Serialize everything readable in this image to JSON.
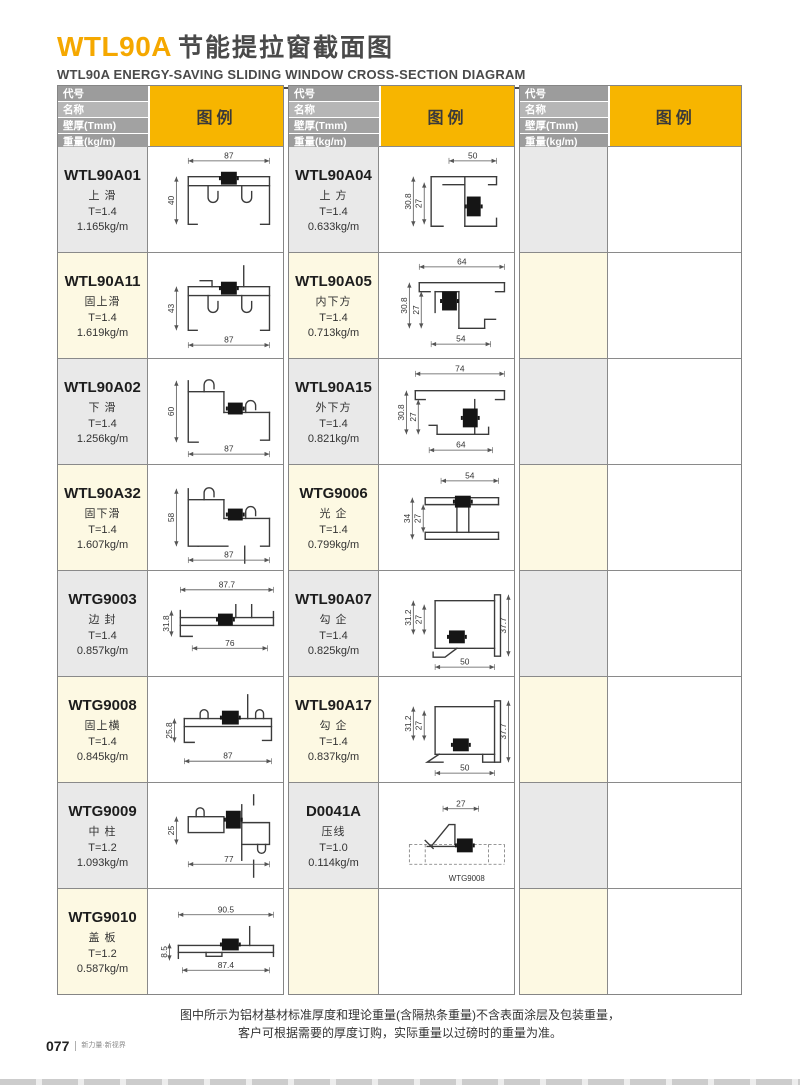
{
  "page": {
    "title_code": "WTL90A",
    "title_cn": "节能提拉窗截面图",
    "subtitle": "WTL90A ENERGY-SAVING SLIDING WINDOW CROSS-SECTION DIAGRAM",
    "note_line1": "图中所示为铝材基材标准厚度和理论重量(含隔热条重量)不含表面涂层及包装重量，",
    "note_line2": "客户可根据需要的厚度订购，实际重量以过磅时的重量为准。",
    "page_number": "077",
    "brand": "新力量·新视界"
  },
  "table_header": {
    "col_labels": [
      "代号",
      "名称",
      "壁厚(Tmm)",
      "重量(kg/m)"
    ],
    "legend_label": "图例"
  },
  "colors": {
    "accent_yellow": "#f7b500",
    "title_orange": "#f5a800",
    "header_gray_dark": "#9c9c9c",
    "header_gray_light": "#b6b6b6",
    "info_gray": "#e9e9e9",
    "info_cream": "#fdf9e3"
  },
  "columns": [
    {
      "rows": [
        {
          "code": "WTL90A01",
          "name": "上 滑",
          "thickness": "T=1.4",
          "weight": "1.165kg/m",
          "dims": {
            "top": "87",
            "left": "40"
          }
        },
        {
          "code": "WTL90A11",
          "name": "固上滑",
          "thickness": "T=1.4",
          "weight": "1.619kg/m",
          "dims": {
            "left": "43",
            "bottom": "87"
          }
        },
        {
          "code": "WTL90A02",
          "name": "下 滑",
          "thickness": "T=1.4",
          "weight": "1.256kg/m",
          "dims": {
            "left": "60",
            "bottom": "87"
          }
        },
        {
          "code": "WTL90A32",
          "name": "固下滑",
          "thickness": "T=1.4",
          "weight": "1.607kg/m",
          "dims": {
            "left": "58",
            "bottom": "87"
          }
        },
        {
          "code": "WTG9003",
          "name": "边 封",
          "thickness": "T=1.4",
          "weight": "0.857kg/m",
          "dims": {
            "top": "87.7",
            "left": "31.8",
            "bottom": "76"
          }
        },
        {
          "code": "WTG9008",
          "name": "固上横",
          "thickness": "T=1.4",
          "weight": "0.845kg/m",
          "dims": {
            "left": "25.8",
            "bottom": "87"
          }
        },
        {
          "code": "WTG9009",
          "name": "中 柱",
          "thickness": "T=1.2",
          "weight": "1.093kg/m",
          "dims": {
            "left": "25",
            "bottom": "77"
          }
        },
        {
          "code": "WTG9010",
          "name": "盖 板",
          "thickness": "T=1.2",
          "weight": "0.587kg/m",
          "dims": {
            "top": "90.5",
            "left": "8.5",
            "bottom": "87.4"
          }
        }
      ]
    },
    {
      "rows": [
        {
          "code": "WTL90A04",
          "name": "上 方",
          "thickness": "T=1.4",
          "weight": "0.633kg/m",
          "dims": {
            "top": "50",
            "left": "30.8",
            "inner": "27"
          }
        },
        {
          "code": "WTL90A05",
          "name": "内下方",
          "thickness": "T=1.4",
          "weight": "0.713kg/m",
          "dims": {
            "top": "64",
            "left": "30.8",
            "inner": "27",
            "bottom": "54"
          }
        },
        {
          "code": "WTL90A15",
          "name": "外下方",
          "thickness": "T=1.4",
          "weight": "0.821kg/m",
          "dims": {
            "top": "74",
            "left": "30.8",
            "inner": "27",
            "bottom": "64"
          }
        },
        {
          "code": "WTG9006",
          "name": "光 企",
          "thickness": "T=1.4",
          "weight": "0.799kg/m",
          "dims": {
            "top": "54",
            "left": "34",
            "inner": "27"
          }
        },
        {
          "code": "WTL90A07",
          "name": "勾 企",
          "thickness": "T=1.4",
          "weight": "0.825kg/m",
          "dims": {
            "left": "31.2",
            "inner": "27",
            "right": "37.7",
            "bottom": "50"
          }
        },
        {
          "code": "WTL90A17",
          "name": "勾 企",
          "thickness": "T=1.4",
          "weight": "0.837kg/m",
          "dims": {
            "left": "31.2",
            "inner": "27",
            "right": "37.7",
            "bottom": "50"
          }
        },
        {
          "code": "D0041A",
          "name": "压线",
          "thickness": "T=1.0",
          "weight": "0.114kg/m",
          "dims": {
            "top": "27"
          },
          "ref": "WTG9008"
        },
        {
          "empty": true
        }
      ]
    },
    {
      "rows": [
        {
          "empty": true
        },
        {
          "empty": true
        },
        {
          "empty": true
        },
        {
          "empty": true
        },
        {
          "empty": true
        },
        {
          "empty": true
        },
        {
          "empty": true
        },
        {
          "empty": true
        }
      ]
    }
  ]
}
